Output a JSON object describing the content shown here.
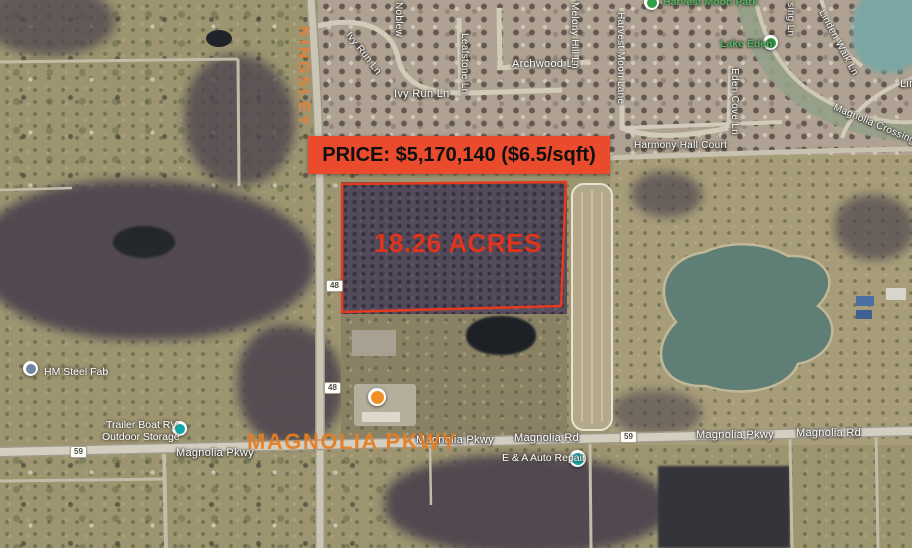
{
  "listing": {
    "price_banner": "PRICE: $5,170,140 ($6.5/sqft)",
    "acreage_label": "18.26 ACRES",
    "street_highlight": "KINGSLEY",
    "road_highlight": "MAGNOLIA PKWY",
    "colors": {
      "banner_background": "#e94b2c",
      "banner_text": "#101010",
      "parcel_outline": "#e53a1e",
      "acreage_text": "#e0341c",
      "highlight_orange": "#e0812f"
    }
  },
  "map": {
    "street_labels": [
      {
        "text": "Noblew"
      },
      {
        "text": "Ivy Run Ln"
      },
      {
        "text": "Leafstone Ln"
      },
      {
        "text": "Ivy Run Ln"
      },
      {
        "text": "Archwood Ln"
      },
      {
        "text": "Melony Hill Ln"
      },
      {
        "text": "Harvest Moon Lane"
      },
      {
        "text": "sing Ln"
      },
      {
        "text": "Linden Walk Ln"
      },
      {
        "text": "Eden Cove Ln"
      },
      {
        "text": "Magnolia Crossing Ln"
      },
      {
        "text": "Lin"
      },
      {
        "text": "Harmony Hall Court"
      },
      {
        "text": "Magnolia Pkwy"
      },
      {
        "text": "Magnolia Rd"
      },
      {
        "text": "Magnolia Pkwy"
      },
      {
        "text": "Magnolia Rd"
      },
      {
        "text": "Magnolia Pkwy"
      }
    ],
    "poi_labels": [
      {
        "text": "Harvest Moon Park"
      },
      {
        "text": "Lake Eden"
      },
      {
        "text": "HM Steel Fab"
      },
      {
        "line1": "Trailer Boat RV",
        "line2": "Outdoor Storage"
      },
      {
        "text": "E & A Auto Repair"
      }
    ],
    "route_shields": [
      "48",
      "48",
      "59",
      "59"
    ]
  }
}
